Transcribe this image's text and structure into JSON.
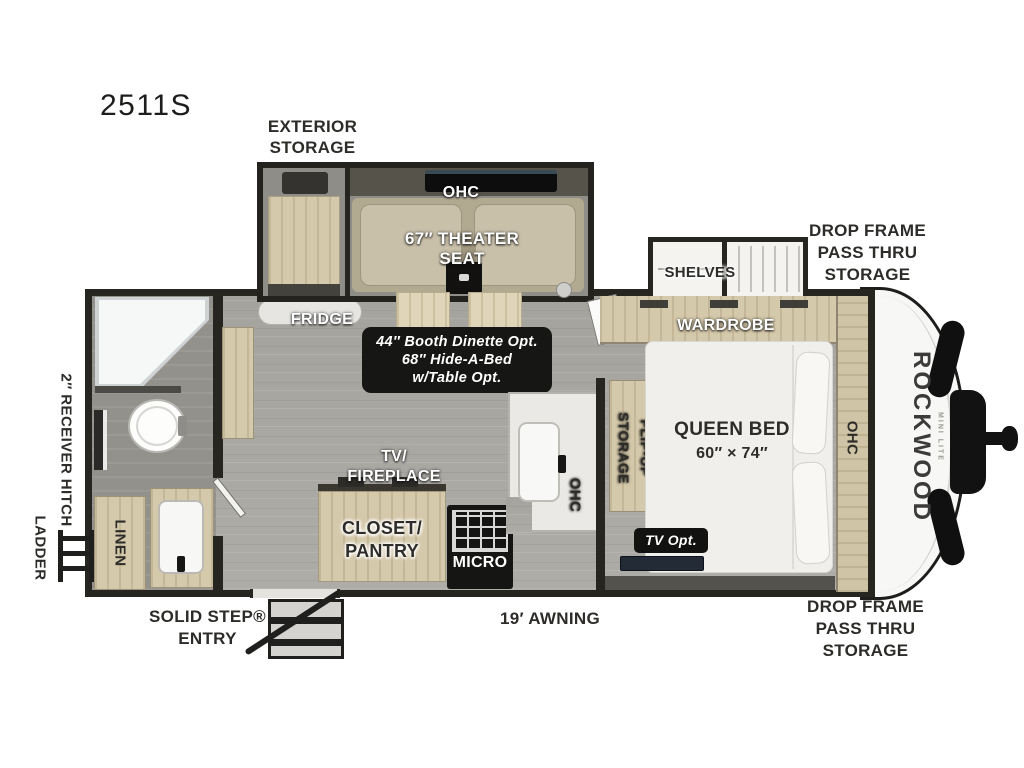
{
  "meta": {
    "model": "2511S"
  },
  "palette": {
    "wall": "#26251f",
    "floor": "#aaa8a3",
    "cabinet_wood": "#d5c9ab",
    "theater_seat": "#b2a991",
    "note_box": "#161614",
    "label_dark": "#2d2c29",
    "label_white": "#ffffff"
  },
  "exterior": {
    "exterior_storage": [
      "EXTERIOR",
      "STORAGE"
    ],
    "drop_frame_top": [
      "DROP FRAME",
      "PASS THRU",
      "STORAGE"
    ],
    "drop_frame_bottom": [
      "DROP FRAME",
      "PASS THRU",
      "STORAGE"
    ],
    "ladder": "LADDER",
    "receiver_hitch": "2″ RECEIVER HITCH",
    "solid_step": [
      "SOLID STEP®",
      "ENTRY"
    ],
    "awning": "19′ AWNING"
  },
  "slideout": {
    "ohc": "OHC",
    "theater_seat": [
      "67″ THEATER",
      "SEAT"
    ]
  },
  "living": {
    "fridge": "FRIDGE",
    "dinette_option": [
      "44″ Booth Dinette Opt.",
      "68″ Hide-A-Bed",
      "w/Table Opt."
    ],
    "tv_fireplace": [
      "TV/",
      "FIREPLACE"
    ],
    "closet_pantry": [
      "CLOSET/",
      "PANTRY"
    ]
  },
  "kitchen": {
    "micro": "MICRO",
    "ohc": "OHC"
  },
  "bedroom": {
    "shelves": "SHELVES",
    "wardrobe": "WARDROBE",
    "flip_up_storage": [
      "FLIP-UP",
      "STORAGE"
    ],
    "queen_bed": [
      "QUEEN BED",
      "60″ × 74″"
    ],
    "ohc": "OHC",
    "tv_opt": "TV Opt."
  },
  "bathroom": {
    "linen": "LINEN"
  },
  "brand": {
    "name": "ROCKWOOD",
    "series": "MINI LITE"
  }
}
